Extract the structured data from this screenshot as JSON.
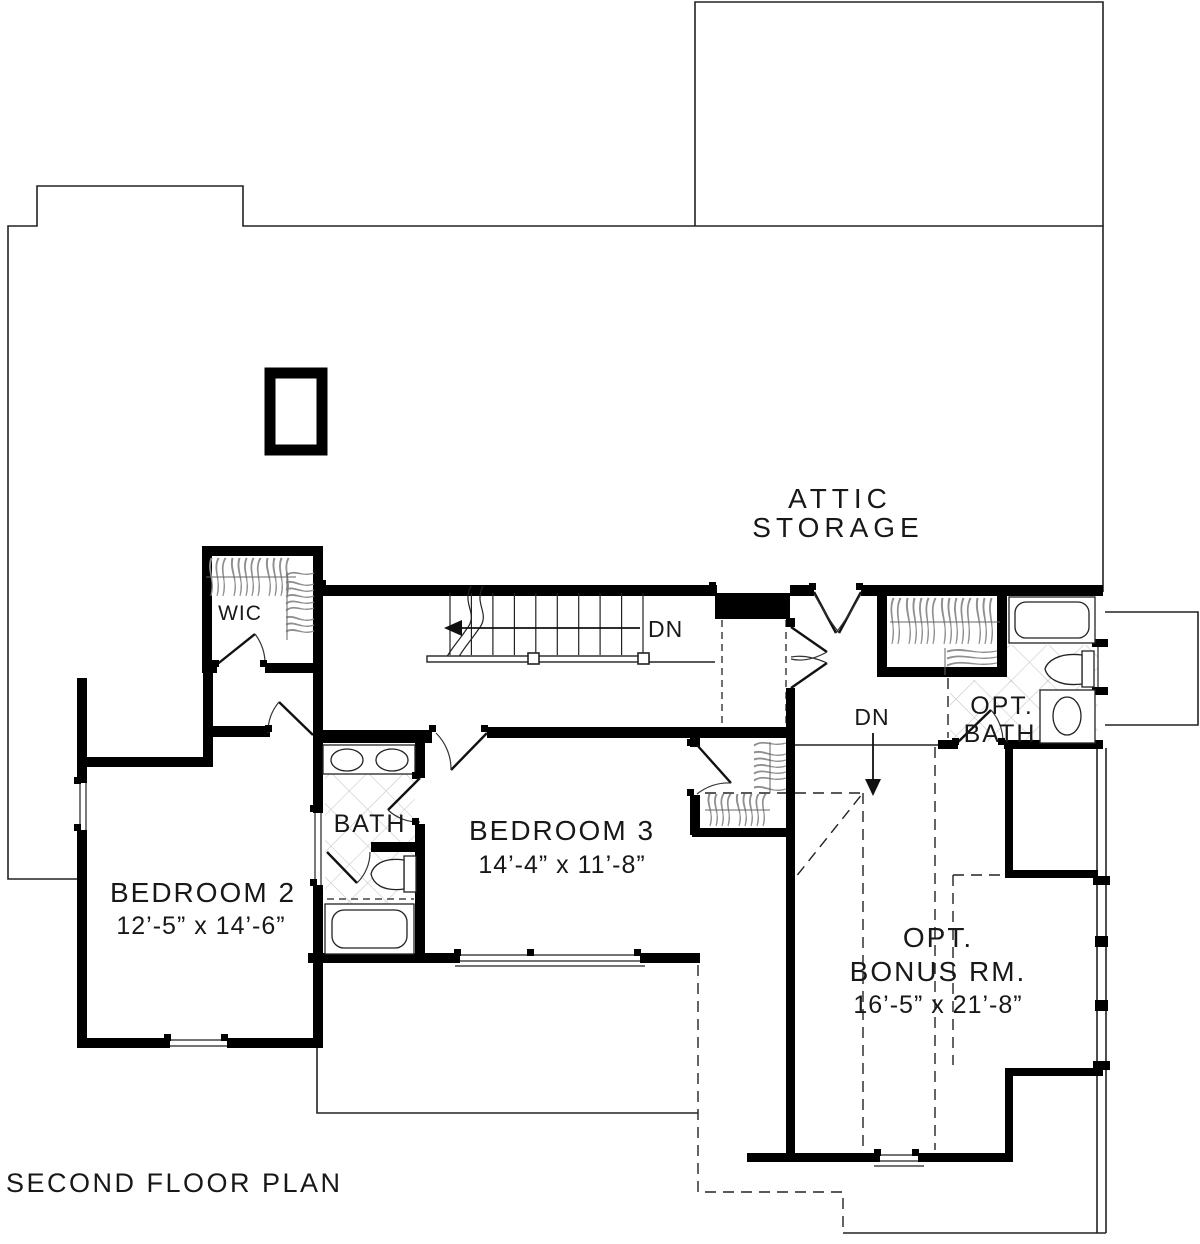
{
  "title": "SECOND FLOOR PLAN",
  "rooms": {
    "attic_storage": {
      "line1": "ATTIC",
      "line2": "STORAGE"
    },
    "wic": {
      "label": "WIC"
    },
    "bedroom2": {
      "label": "BEDROOM 2",
      "dims": "12’-5” x 14’-6”"
    },
    "bedroom3": {
      "label": "BEDROOM 3",
      "dims": "14’-4” x 11’-8”"
    },
    "bath": {
      "label": "BATH"
    },
    "opt_bath": {
      "line1": "OPT.",
      "line2": "BATH"
    },
    "bonus": {
      "line1": "OPT.",
      "line2": "BONUS RM.",
      "dims": "16’-5” x 21’-8”"
    }
  },
  "annotations": {
    "stairs_down": "DN",
    "hall_down": "DN"
  },
  "colors": {
    "wall": "#000000",
    "line": "#222222",
    "hatch": "#c9c9c9",
    "hanger": "#8f8f8f"
  }
}
